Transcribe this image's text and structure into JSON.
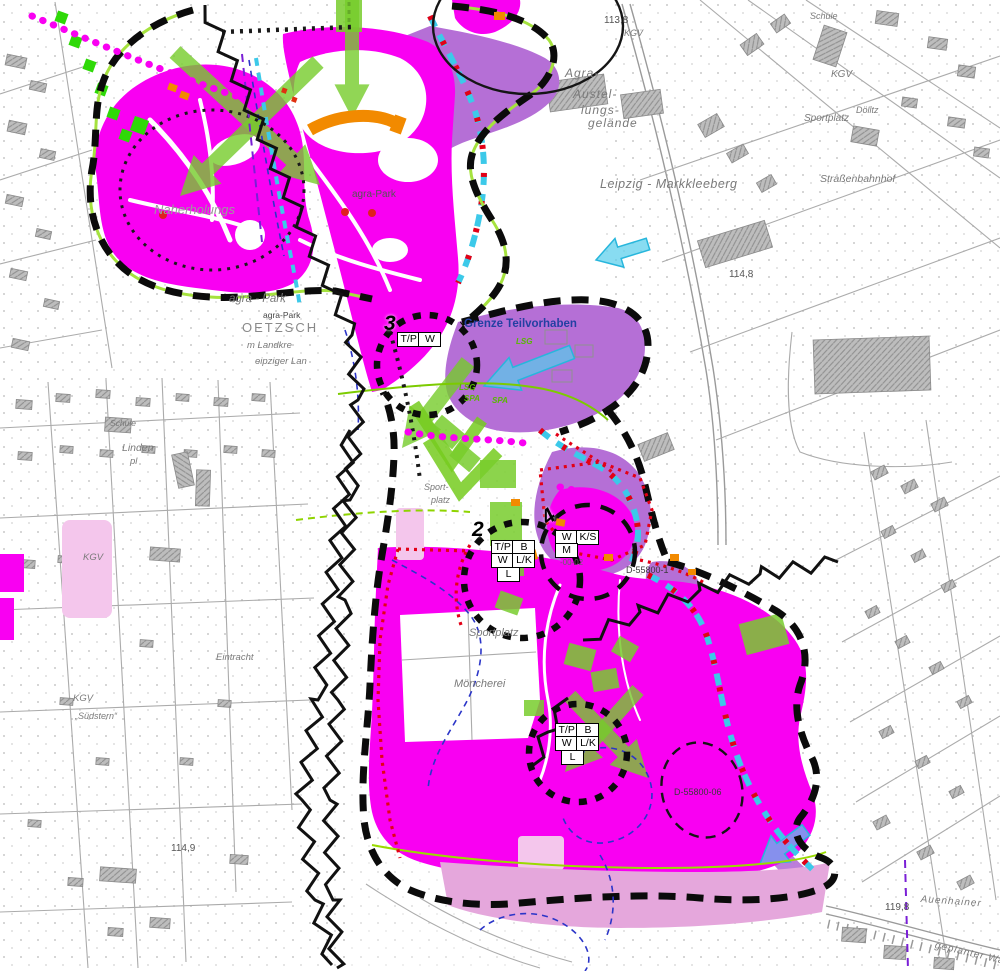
{
  "colors": {
    "magenta": "#f900f2",
    "violet": "#b56fd6",
    "light_pink": "#f4c6ec",
    "deep_pink": "#e5a7dc",
    "green": "#64cc1e",
    "bright_green": "#2fd908",
    "cyan": "#3cc9e9",
    "red": "#e30016",
    "orange": "#f28a00",
    "boundary_black": "#0b0b0b",
    "blue_text": "#2340a2",
    "base_gray": "#9a9a9a"
  },
  "labels": {
    "schule_tr": "Schule",
    "kgv_tr": "KGV",
    "doelitz": "Dölitz",
    "sportplatz_tr": "Sportplatz",
    "elev_113_8": "113,8",
    "kgv_tc": "KGV",
    "agra_1": "Agra-",
    "agra_2": "Austel-",
    "agra_3": "lungs-",
    "agra_4": "gelände",
    "leipzig_markkleeberg": "Leipzig - Markkleeberg",
    "strassenbahnhof": "Straßenbahnhof",
    "naherholungs": "Naherholungs",
    "agra_park_center": "agra-Park",
    "agra_park_west": "agra - Park",
    "agra_park_west_small": "agra-Park",
    "oetzsch": "OETZSCH",
    "landkreis_frag": "m Landkre",
    "leipziger_land_frag": "eipziger Lan",
    "grenze_teilvorhaben": "Grenze Teilvorhaben",
    "elev_114_8": "114,8",
    "sport_base_1": "Sport-",
    "sport_base_2": "platz",
    "linden": "Linden",
    "linden_pl": "pl",
    "sportplatz_overlay": "Sportplatz",
    "moencherei": "Möncherei",
    "kgv_left": "KGV",
    "kgv_bottom_left": "KGV",
    "suedstern": "„Südstern“",
    "eintracht": "Eintracht",
    "schule_left": "Schule",
    "elev_114_9": "114,9",
    "elev_119_8": "119,8",
    "auenhainer": "Auenhainer",
    "geplanter": "geplanter Was",
    "d_55800_1": "D-55800-1",
    "d_55800_06": "D-55800-06",
    "frag_00_02": "-00-02",
    "lsg_a": "LSG",
    "lsg_b": "LSG",
    "spa_a": "SPA",
    "spa_b": "SPA"
  },
  "markers": {
    "m3": {
      "number": "3",
      "cells": [
        [
          "T/P",
          "W"
        ]
      ]
    },
    "m2": {
      "number": "2",
      "cells": [
        [
          "T/P",
          "B"
        ],
        [
          "W",
          "L/K"
        ],
        [
          "L"
        ]
      ]
    },
    "m4": {
      "number": "4",
      "cells": [
        [
          "W",
          "K/S"
        ],
        [
          "M"
        ]
      ]
    },
    "m5": {
      "cells": [
        [
          "T/P",
          "B"
        ],
        [
          "W",
          "L/K"
        ],
        [
          "L"
        ]
      ]
    }
  }
}
